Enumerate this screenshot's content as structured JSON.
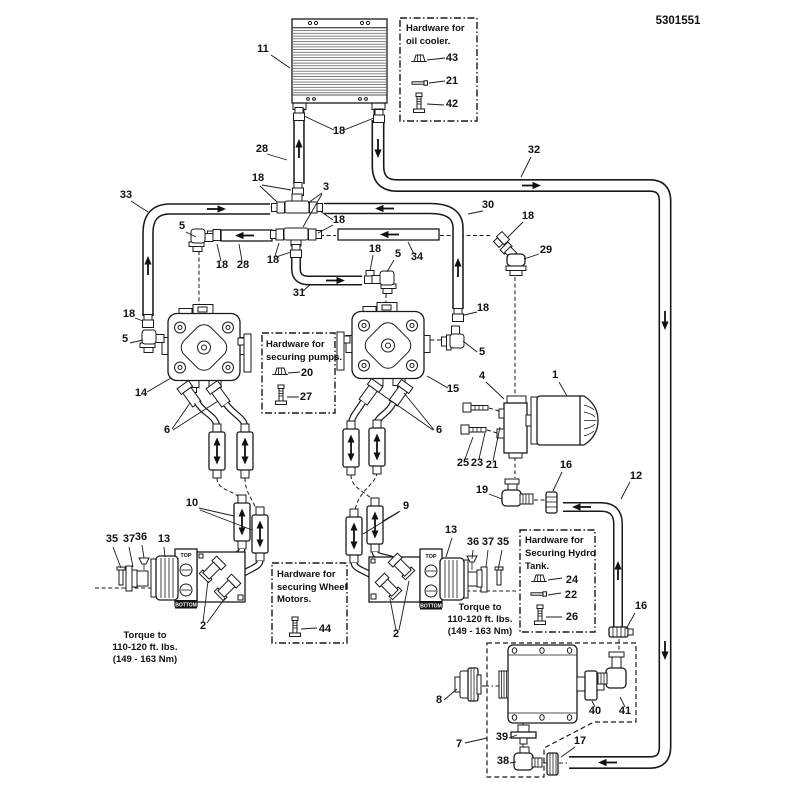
{
  "doc_number": "5301551",
  "parts": {
    "p1": "1",
    "p2": "2",
    "p3": "3",
    "p4": "4",
    "p5": "5",
    "p6": "6",
    "p7": "7",
    "p8": "8",
    "p9": "9",
    "p10": "10",
    "p11": "11",
    "p12": "12",
    "p13": "13",
    "p14": "14",
    "p15": "15",
    "p16": "16",
    "p17": "17",
    "p18": "18",
    "p19": "19",
    "p20": "20",
    "p21": "21",
    "p22": "22",
    "p23": "23",
    "p24": "24",
    "p25": "25",
    "p26": "26",
    "p27": "27",
    "p28": "28",
    "p29": "29",
    "p30": "30",
    "p31": "31",
    "p32": "32",
    "p33": "33",
    "p34": "34",
    "p35": "35",
    "p36": "36",
    "p37": "37",
    "p38": "38",
    "p39": "39",
    "p40": "40",
    "p41": "41",
    "p42": "42",
    "p43": "43",
    "p44": "44"
  },
  "hardware_boxes": {
    "oil_cooler": {
      "line1": "Hardware for",
      "line2": "oil cooler."
    },
    "pumps": {
      "line1": "Hardware for",
      "line2": "securing pumps."
    },
    "wheel_motors": {
      "line1": "Hardware for",
      "line2": "securing Wheel",
      "line3": "Motors."
    },
    "hydro_tank": {
      "line1": "Hardware for",
      "line2": "Securing Hydro",
      "line3": "Tank."
    }
  },
  "torque_note": {
    "line1": "Torque to",
    "line2": "110-120 ft. lbs.",
    "line3": "(149 - 163 Nm)"
  },
  "motor_labels": {
    "top": "TOP",
    "bottom": "BOTTOM"
  },
  "colors": {
    "line": "#1a1a1a",
    "background": "#ffffff"
  }
}
